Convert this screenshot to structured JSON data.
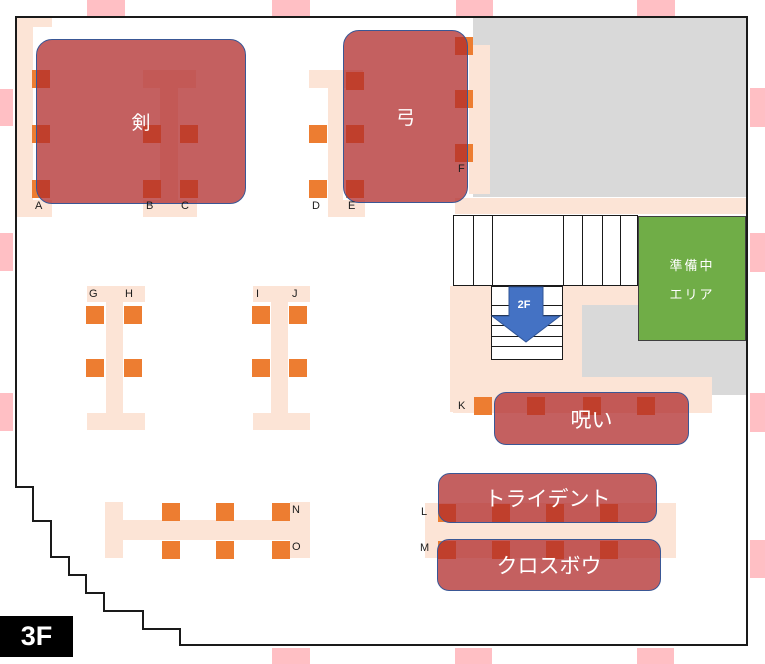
{
  "floor": {
    "current": "3F",
    "down": "2F"
  },
  "prep_area": {
    "line1": "準備中",
    "line2": "エリア"
  },
  "colors": {
    "pink_mark": "#ffbfc4",
    "peach_table": "#fce4d6",
    "orange_seat": "#ed7d31",
    "gray_area": "#d9d9d9",
    "green_area": "#70ad47",
    "zone_fill_rgba": "rgba(176,43,43,0.75)",
    "zone_border": "#3a5795",
    "arrow_blue": "#4472c4",
    "outline_black": "#1a1a1a"
  },
  "zones": [
    {
      "name": "sword",
      "label": "剣",
      "x": 36,
      "y": 39,
      "w": 210,
      "h": 165,
      "r": 16,
      "fs": 19
    },
    {
      "name": "bow",
      "label": "弓",
      "x": 343,
      "y": 30,
      "w": 125,
      "h": 173,
      "r": 16,
      "fs": 19
    },
    {
      "name": "curse",
      "label": "呪い",
      "x": 494,
      "y": 392,
      "w": 195,
      "h": 53,
      "r": 12,
      "fs": 21
    },
    {
      "name": "trident",
      "label": "トライデント",
      "x": 438,
      "y": 473,
      "w": 219,
      "h": 50,
      "r": 12,
      "fs": 21
    },
    {
      "name": "crossbow",
      "label": "クロスボウ",
      "x": 437,
      "y": 539,
      "w": 224,
      "h": 52,
      "r": 12,
      "fs": 21
    }
  ],
  "seat_labels": [
    {
      "label": "A",
      "x": 35,
      "y": 200
    },
    {
      "label": "B",
      "x": 146,
      "y": 200
    },
    {
      "label": "C",
      "x": 181,
      "y": 200
    },
    {
      "label": "D",
      "x": 312,
      "y": 200
    },
    {
      "label": "E",
      "x": 348,
      "y": 200
    },
    {
      "label": "F",
      "x": 458,
      "y": 163
    },
    {
      "label": "G",
      "x": 89,
      "y": 288
    },
    {
      "label": "H",
      "x": 125,
      "y": 288
    },
    {
      "label": "I",
      "x": 256,
      "y": 288
    },
    {
      "label": "J",
      "x": 292,
      "y": 288
    },
    {
      "label": "K",
      "x": 458,
      "y": 400
    },
    {
      "label": "L",
      "x": 421,
      "y": 506
    },
    {
      "label": "M",
      "x": 420,
      "y": 542
    },
    {
      "label": "N",
      "x": 292,
      "y": 504
    },
    {
      "label": "O",
      "x": 292,
      "y": 541
    }
  ],
  "seat_groups": [
    {
      "name": "a-column",
      "squares": [
        [
          32,
          70
        ],
        [
          32,
          125
        ],
        [
          32,
          180
        ]
      ]
    },
    {
      "name": "b-column",
      "squares": [
        [
          143,
          125
        ],
        [
          143,
          180
        ]
      ]
    },
    {
      "name": "c-column",
      "squares": [
        [
          180,
          125
        ],
        [
          180,
          180
        ]
      ]
    },
    {
      "name": "d-column",
      "squares": [
        [
          309,
          125
        ],
        [
          309,
          180
        ]
      ]
    },
    {
      "name": "e-column",
      "squares": [
        [
          346,
          72
        ],
        [
          346,
          125
        ],
        [
          346,
          180
        ]
      ]
    },
    {
      "name": "f-column",
      "squares": [
        [
          455,
          37
        ],
        [
          455,
          90
        ],
        [
          455,
          144
        ]
      ]
    },
    {
      "name": "g-column",
      "squares": [
        [
          86,
          306
        ],
        [
          86,
          359
        ]
      ]
    },
    {
      "name": "h-column",
      "squares": [
        [
          124,
          306
        ],
        [
          124,
          359
        ]
      ]
    },
    {
      "name": "i-column",
      "squares": [
        [
          252,
          306
        ],
        [
          252,
          359
        ]
      ]
    },
    {
      "name": "j-column",
      "squares": [
        [
          289,
          306
        ],
        [
          289,
          359
        ]
      ]
    },
    {
      "name": "k-seat",
      "squares": [
        [
          474,
          397
        ]
      ]
    },
    {
      "name": "curse-row",
      "squares": [
        [
          527,
          397
        ],
        [
          583,
          397
        ],
        [
          637,
          397
        ]
      ]
    },
    {
      "name": "l-row",
      "squares": [
        [
          438,
          504
        ],
        [
          492,
          504
        ],
        [
          546,
          504
        ],
        [
          600,
          504
        ]
      ]
    },
    {
      "name": "m-row",
      "squares": [
        [
          438,
          541
        ],
        [
          492,
          541
        ],
        [
          546,
          541
        ],
        [
          600,
          541
        ]
      ]
    },
    {
      "name": "no-top",
      "squares": [
        [
          162,
          503
        ],
        [
          216,
          503
        ],
        [
          272,
          503
        ]
      ]
    },
    {
      "name": "no-bottom",
      "squares": [
        [
          162,
          541
        ],
        [
          216,
          541
        ],
        [
          272,
          541
        ]
      ]
    }
  ],
  "seat_size": 18,
  "tables": [
    {
      "name": "a-column-stem",
      "x": 16,
      "y": 17,
      "w": 17,
      "h": 200
    },
    {
      "name": "a-column-top",
      "x": 16,
      "y": 17,
      "w": 36,
      "h": 10
    },
    {
      "name": "a-column-bottom",
      "x": 16,
      "y": 200,
      "w": 36,
      "h": 17
    },
    {
      "name": "sword-table-top",
      "x": 143,
      "y": 70,
      "w": 53,
      "h": 18
    },
    {
      "name": "sword-table-stem",
      "x": 160,
      "y": 88,
      "w": 18,
      "h": 112
    },
    {
      "name": "sword-table-bot",
      "x": 143,
      "y": 200,
      "w": 54,
      "h": 17
    },
    {
      "name": "de-table-top",
      "x": 309,
      "y": 70,
      "w": 54,
      "h": 18
    },
    {
      "name": "de-table-stem",
      "x": 328,
      "y": 88,
      "w": 15,
      "h": 112
    },
    {
      "name": "de-table-bottom",
      "x": 328,
      "y": 200,
      "w": 37,
      "h": 17
    },
    {
      "name": "f-table-band",
      "x": 469,
      "y": 45,
      "w": 21,
      "h": 149
    },
    {
      "name": "gh-table-top",
      "x": 87,
      "y": 286,
      "w": 58,
      "h": 16
    },
    {
      "name": "gh-table-stem",
      "x": 106,
      "y": 302,
      "w": 17,
      "h": 111
    },
    {
      "name": "gh-table-bottom",
      "x": 87,
      "y": 413,
      "w": 58,
      "h": 17
    },
    {
      "name": "ij-table-top",
      "x": 253,
      "y": 286,
      "w": 57,
      "h": 16
    },
    {
      "name": "ij-table-stem",
      "x": 271,
      "y": 302,
      "w": 17,
      "h": 111
    },
    {
      "name": "ij-table-bottom",
      "x": 253,
      "y": 413,
      "w": 57,
      "h": 17
    },
    {
      "name": "upper-right-strip",
      "x": 455,
      "y": 198,
      "w": 292,
      "h": 16
    },
    {
      "name": "stairs-landing-1",
      "x": 450,
      "y": 286,
      "w": 188,
      "h": 19
    },
    {
      "name": "stairs-landing-2",
      "x": 450,
      "y": 305,
      "w": 132,
      "h": 107
    },
    {
      "name": "stairs-landing-3",
      "x": 453,
      "y": 377,
      "w": 259,
      "h": 36
    },
    {
      "name": "lm-counter",
      "x": 425,
      "y": 503,
      "w": 251,
      "h": 55
    },
    {
      "name": "no-table-left",
      "x": 105,
      "y": 502,
      "w": 18,
      "h": 56
    },
    {
      "name": "no-table-bar",
      "x": 105,
      "y": 520,
      "w": 205,
      "h": 20
    },
    {
      "name": "no-table-right",
      "x": 290,
      "y": 502,
      "w": 20,
      "h": 56
    }
  ],
  "gray_areas": [
    {
      "name": "gray-top-right",
      "x": 473,
      "y": 18,
      "w": 274,
      "h": 179
    },
    {
      "name": "gray-mid-right",
      "x": 582,
      "y": 305,
      "w": 165,
      "h": 90
    }
  ],
  "pink_marks": [
    {
      "side": "top",
      "x": 87,
      "y": 0,
      "w": 38,
      "h": 16
    },
    {
      "side": "top",
      "x": 272,
      "y": 0,
      "w": 38,
      "h": 16
    },
    {
      "side": "top",
      "x": 456,
      "y": 0,
      "w": 37,
      "h": 16
    },
    {
      "side": "top",
      "x": 637,
      "y": 0,
      "w": 38,
      "h": 16
    },
    {
      "side": "bottom",
      "x": 272,
      "y": 648,
      "w": 38,
      "h": 16
    },
    {
      "side": "bottom",
      "x": 455,
      "y": 648,
      "w": 37,
      "h": 16
    },
    {
      "side": "bottom",
      "x": 637,
      "y": 648,
      "w": 37,
      "h": 16
    },
    {
      "side": "left",
      "x": 0,
      "y": 89,
      "w": 13,
      "h": 37
    },
    {
      "side": "left",
      "x": 0,
      "y": 233,
      "w": 13,
      "h": 38
    },
    {
      "side": "left",
      "x": 0,
      "y": 393,
      "w": 13,
      "h": 38
    },
    {
      "side": "right",
      "x": 750,
      "y": 88,
      "w": 15,
      "h": 39
    },
    {
      "side": "right",
      "x": 750,
      "y": 233,
      "w": 15,
      "h": 39
    },
    {
      "side": "right",
      "x": 750,
      "y": 393,
      "w": 15,
      "h": 39
    },
    {
      "side": "right",
      "x": 750,
      "y": 540,
      "w": 15,
      "h": 38
    }
  ],
  "stairs": {
    "upper": {
      "x": 453,
      "y": 215,
      "w": 185,
      "h": 71,
      "line_xs": [
        473,
        492,
        563,
        582,
        602,
        620
      ]
    },
    "lower": {
      "x": 491,
      "y": 286,
      "w": 72,
      "h": 74,
      "line_ys": [
        305,
        315,
        325,
        336,
        346
      ]
    }
  },
  "outline_points": "16,17 747,17 747,645 180,645 180,629 143,629 143,611 104,611 104,593 86,593 86,575 69,575 69,557 51,557 51,521 33,521 33,487 16,487"
}
